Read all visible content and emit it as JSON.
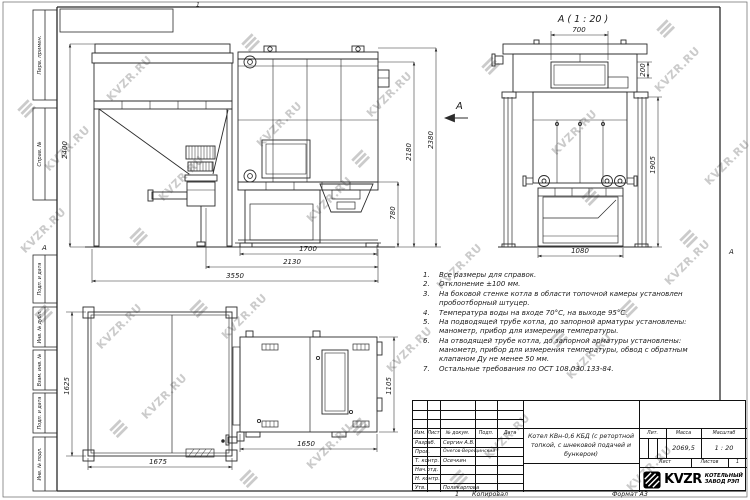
{
  "page": {
    "top_mark": "1",
    "bottom_sheet_mark": "1",
    "copied_label": "Копировал",
    "format_label": "Формат А3",
    "zone_left": "А",
    "zone_right": "А"
  },
  "watermark": {
    "text": "KVZR.RU"
  },
  "frame": {
    "labels": [
      "Перв. примен.",
      "Справ. №",
      "Подп. и дата",
      "Инв. № дубл.",
      "Взам. инв. №",
      "Подп. и дата",
      "Инв. № подл."
    ]
  },
  "views": {
    "section_title": "А ( 1 : 20 )",
    "section_arrow": "А",
    "front_dims": {
      "bunker_height": "2400",
      "boiler_inner_height": "2180",
      "total_height": "2380",
      "lower_height": "780",
      "boiler_width": "1700",
      "mid_width": "2130",
      "total_width": "3550"
    },
    "section_dims": {
      "top_opening_width": "700",
      "opening_height": "200",
      "body_height": "1905",
      "bottom_width": "1080"
    },
    "plan_dims": {
      "bunker_depth": "1625",
      "bunker_width": "1675",
      "boiler_width": "1650",
      "boiler_depth": "1105"
    }
  },
  "notes": [
    "Все размеры для справок.",
    "Отклонение ±100 мм.",
    "На боковой стенке котла в области топочной камеры установлен пробоотборный штуцер.",
    "Температура воды на входе 70°С, на выходе 95°С.",
    "На подводящей трубе котла, до запорной арматуры установлены: манометр, прибор для измерения температуры.",
    "На отводящей трубе котла, до запорной арматуры установлены: манометр, прибор для измерения температуры, обвод с обратным клапаном Ду не менее 50 мм.",
    "Остальные требования по ОСТ 108.030.133-84."
  ],
  "title_block": {
    "cols": {
      "izm": "Изм.",
      "list": "Лист",
      "doc": "№ докум.",
      "sign": "Подп.",
      "date": "Дата"
    },
    "rows": [
      {
        "role": "Разраб.",
        "name": "Сергин А.В."
      },
      {
        "role": "Пров.",
        "name": "Онегов-Верещинский"
      },
      {
        "role": "Т. контр.",
        "name": "Осечкин"
      },
      {
        "role": "Нач.отд.",
        "name": ""
      },
      {
        "role": "Н. контр.",
        "name": ""
      },
      {
        "role": "Утв.",
        "name": "Поликарпова"
      }
    ],
    "title": "Котел КВн-0,6 КБД (с ретортной топкой, с шнековой подачей и бункером)",
    "lit_label": "Лит.",
    "mass_label": "Масса",
    "scale_label": "Масштаб",
    "mass": "2069,5",
    "scale": "1 : 20",
    "sheet_label": "Лист",
    "sheets_label": "Листов",
    "sheets": "1",
    "logo": "KVZR",
    "company": [
      "КОТЕЛЬНЫЙ",
      "ЗАВОД РЭП"
    ]
  },
  "colors": {
    "line": "#2b2b2b",
    "watermark": "#cbcbcb",
    "text": "#1a1a1a"
  }
}
